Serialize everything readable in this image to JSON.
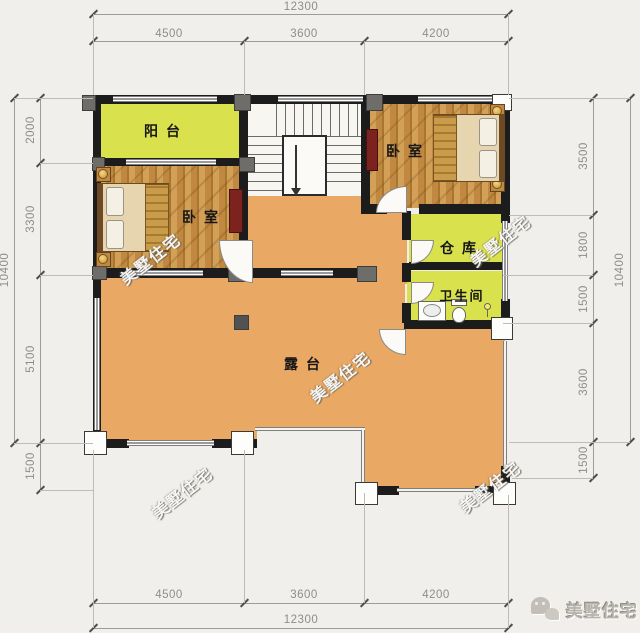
{
  "title": "二层别墅户型平面图",
  "watermark": {
    "text": "美墅住宅"
  },
  "logo": {
    "text": "美墅住宅",
    "icon": "chat-bubbles-icon"
  },
  "rooms": {
    "balcony": {
      "label": "阳台"
    },
    "bedroom_left": {
      "label": "卧室"
    },
    "bedroom_right": {
      "label": "卧室"
    },
    "storage": {
      "label": "仓库"
    },
    "bathroom": {
      "label": "卫生间"
    },
    "terrace": {
      "label": "露台"
    }
  },
  "dimensions": {
    "top": {
      "total": "12300",
      "segments": [
        "4500",
        "3600",
        "4200"
      ]
    },
    "bottom": {
      "total": "12300",
      "segments": [
        "4500",
        "3600",
        "4200"
      ]
    },
    "left": {
      "total": "10400",
      "segments": [
        "2000",
        "3300",
        "5100",
        "1500"
      ]
    },
    "right": {
      "total": "10400",
      "segments": [
        "3500",
        "1800",
        "1500",
        "3600",
        "1500"
      ]
    }
  },
  "colors": {
    "background": "#f0efeb",
    "terrace_floor": "#e9a863",
    "green_floor": "#d9e24d",
    "wood_floor": "#c9954f",
    "wall": "#1c1c1c",
    "dimension_text": "#8d8d8a"
  }
}
